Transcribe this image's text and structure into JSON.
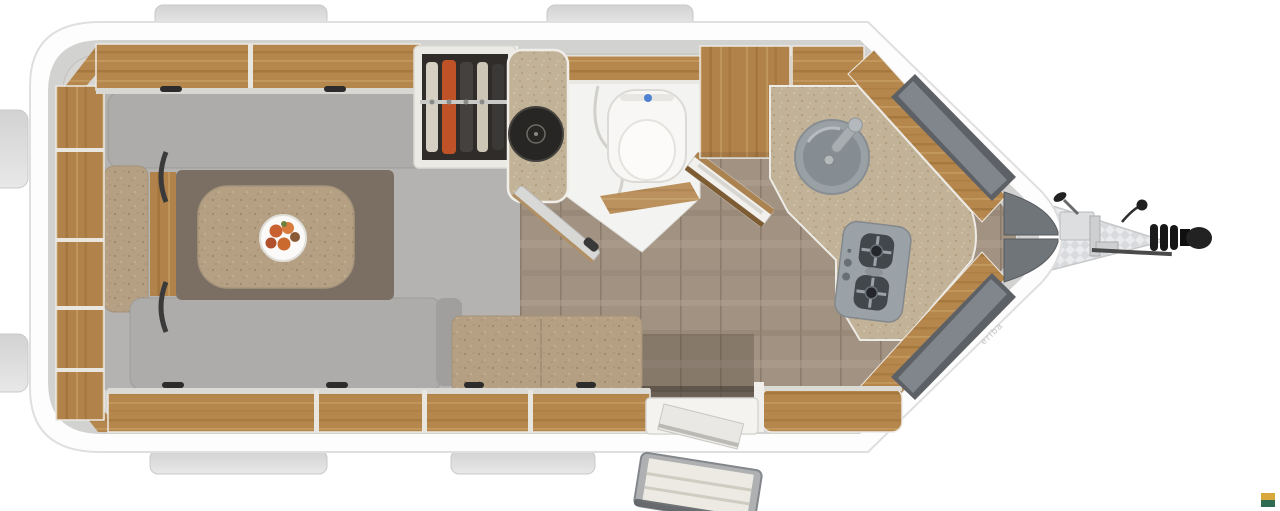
{
  "meta": {
    "description": "Top-view 3D rendered floor plan of a single-axle touring caravan with pointed drawbar front (right), U-shaped lounge with table (left), wardrobe, washroom with toilet, corner kitchen with round sink and 2-burner hob, entry door with exterior step (bottom right)."
  },
  "brand": {
    "trim_text": "eriba"
  },
  "logo": {
    "gold": "#D9A83C",
    "green": "#2F6B50"
  },
  "colors": {
    "shell": "#fdfdfd",
    "shellEdge": "#dfdfdf",
    "bodyBand": "#d2d2d1",
    "interiorBase": "#d7d6d3",
    "tab": "#dcdcdc",
    "platform": "#b4b3b1",
    "cushionGray": "#adacaa",
    "armrestGray": "#a19f9d",
    "tableBase": "#7b6f63",
    "plateWhite": "#fbfaf8",
    "bathFloor": "#f3f3f1",
    "toiletWhite": "#f8f7f5",
    "flushBlue": "#4f82d2",
    "basinDark": "#272624",
    "sinkGray": "#9aa1a5",
    "sinkInner": "#868d92",
    "cooktopGray": "#9aa2a7",
    "burnerDark": "#42474c",
    "windowOuter": "#5d6166",
    "windowInner": "#80868c",
    "noseCap": "#70757a",
    "hitchBlack": "#1b1b1b",
    "metalSilver": "#cdcfd1",
    "doorGray": "#d8d8d6",
    "stepFrame": "#aeb0b2",
    "stepTread": "#eceae3",
    "wardrobeDark": "#2f2c2a",
    "clothesOrange": "#bf5327",
    "matDark": "#3f382f",
    "partitionWhite": "#f1efeb"
  },
  "fixtures": {
    "lounge": "u-shaped-lounge",
    "table": "dinette-table-with-fruit-plate",
    "wardrobe": "wardrobe-with-hanging-clothes",
    "washroom": "washroom-with-toilet",
    "basin": "round-dark-washbasin",
    "kitchen": "corner-kitchen",
    "sink": "round-kitchen-sink",
    "hob": "two-burner-gas-hob",
    "door": "entry-door-with-step",
    "hitch": "drawbar-with-coupling-and-jockey-wheel",
    "windows": "front-panorama-windows",
    "storage": "overhead-lockers-and-shelves"
  }
}
